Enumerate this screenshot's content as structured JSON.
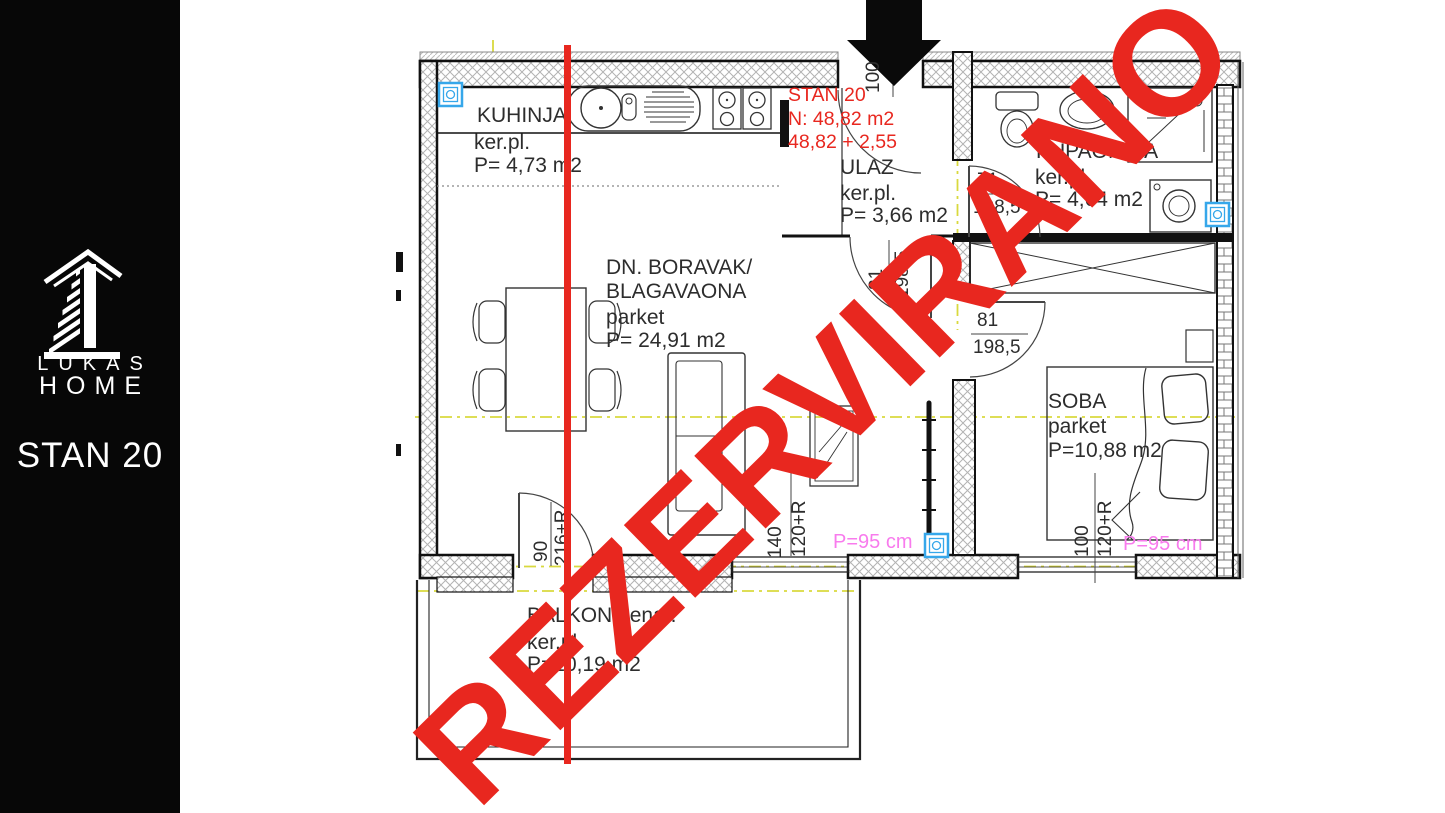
{
  "sidebar": {
    "brand_top": "LUKAS",
    "brand_bottom": "HOME",
    "unit_label": "STAN 20"
  },
  "unit_info": {
    "title": "STAN 20",
    "net": "N: 48,82 m2",
    "sum": "48,82 + 2,55"
  },
  "watermark": "REZERVIRANO",
  "rooms": {
    "kuhinja": {
      "name": "KUHINJA",
      "floor": "ker.pl.",
      "area": "P= 4,73 m2"
    },
    "ulaz": {
      "name": "ULAZ",
      "floor": "ker.pl.",
      "area": "P= 3,66 m2"
    },
    "kupaonica": {
      "name": "KUPAONICA",
      "floor": "ker.pl.",
      "area": "P= 4,64 m2"
    },
    "boravak": {
      "name_line1": "DN. BORAVAK/",
      "name_line2": "BLAGAVAONA",
      "floor": "parket",
      "area": "P= 24,91 m2"
    },
    "soba": {
      "name": "SOBA",
      "floor": "parket",
      "area": "P=10,88 m2"
    },
    "balkon": {
      "name": "BALKON nenat.",
      "floor": "ker.pl.",
      "area": "P=10,19 m2"
    }
  },
  "dims": {
    "door_bath": {
      "w": "71",
      "h": "198,5"
    },
    "door_bedroom": {
      "w": "81",
      "h": "198,5"
    },
    "door_hall": {
      "w": "81",
      "h": "198,5"
    },
    "door_balcony": {
      "w": "90",
      "h": "216+R"
    },
    "door_entry": {
      "w": "100"
    },
    "window_living": {
      "w": "140",
      "h": "120+R"
    },
    "window_bedroom": {
      "w": "100",
      "h": "120+R"
    },
    "parapet_living": "P=95 cm",
    "parapet_bedroom": "P=95 cm"
  },
  "colors": {
    "accent_red": "#e8271f",
    "magenta": "#f87bed",
    "symbol_blue": "#36a7ea",
    "centerline_yellow": "#d9d93e",
    "sidebar_black": "#070707"
  }
}
